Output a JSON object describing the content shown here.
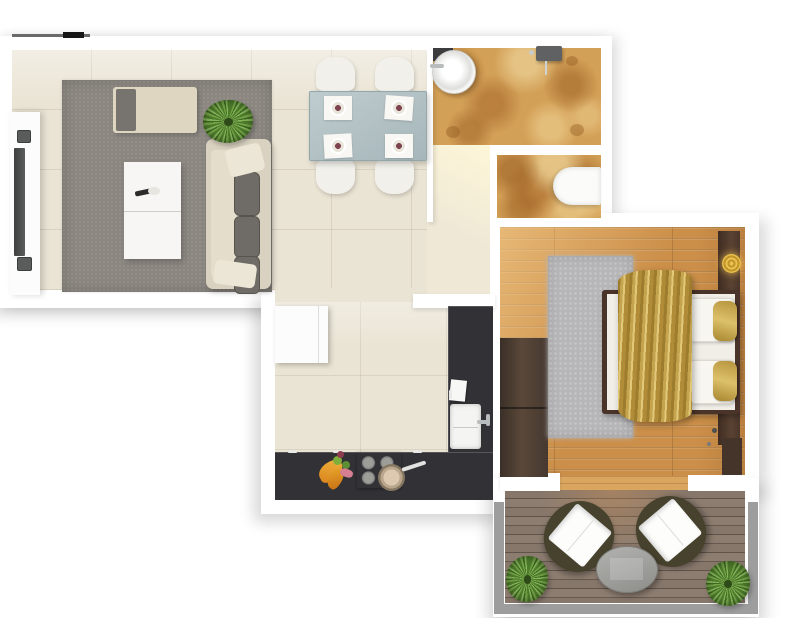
{
  "scene": {
    "type": "apartment-floor-plan-3d-top-view",
    "style": "photorealistic architectural render, no text labels"
  },
  "palette": {
    "background": "#ffffff",
    "walls": "#ffffff",
    "living_floor": "#eae4d4",
    "bathroom_floor": "#d3a057",
    "bedroom_wood_floor": "#cb8f49",
    "balcony_deck": "#7a6b5e",
    "living_rug": "#8b8680",
    "bedroom_rug": "#b6b5b7",
    "sofa_base": "#d9d2c1",
    "sofa_cushions": "#6f6c67",
    "kitchen_counter": "#323236",
    "dark_wood_furniture": "#4a3328",
    "gold_textile": "#c5a44f",
    "glass_table": "#aebfc4",
    "white_furniture": "#f6f5f3",
    "plant_green": "#6d9c3f",
    "railing_gray": "#9d9d9d"
  },
  "rooms": [
    {
      "name": "living-room",
      "furniture": [
        "window-rail",
        "tv-sideboard",
        "tv",
        "speakers",
        "gray-area-rug",
        "daybed-with-pillow",
        "potted-plant",
        "two-part-coffee-table",
        "sofa-with-cushions"
      ]
    },
    {
      "name": "dining-area",
      "furniture": [
        "glass-dining-table",
        "four-white-chairs",
        "four-place-settings"
      ]
    },
    {
      "name": "bathroom",
      "furniture": [
        "round-basin",
        "basin-counter",
        "shower-fixture"
      ]
    },
    {
      "name": "wc",
      "furniture": [
        "toilet"
      ]
    },
    {
      "name": "hallway",
      "furniture": []
    },
    {
      "name": "kitchen",
      "furniture": [
        "refrigerator",
        "l-shaped-counter",
        "cooktop",
        "frying-pan",
        "sink-with-faucet",
        "fruit",
        "towel",
        "cabinet-handles"
      ]
    },
    {
      "name": "bedroom",
      "furniture": [
        "wardrobe",
        "light-gray-rug",
        "double-bed",
        "gold-throw-blanket",
        "white-pillows",
        "gold-pillows",
        "headboard",
        "gold-wall-ornament",
        "nightstand"
      ]
    },
    {
      "name": "balcony",
      "furniture": [
        "lounge-chair-left",
        "lounge-chair-right",
        "oval-table",
        "potted-plant-left",
        "potted-plant-right",
        "railing"
      ]
    }
  ]
}
